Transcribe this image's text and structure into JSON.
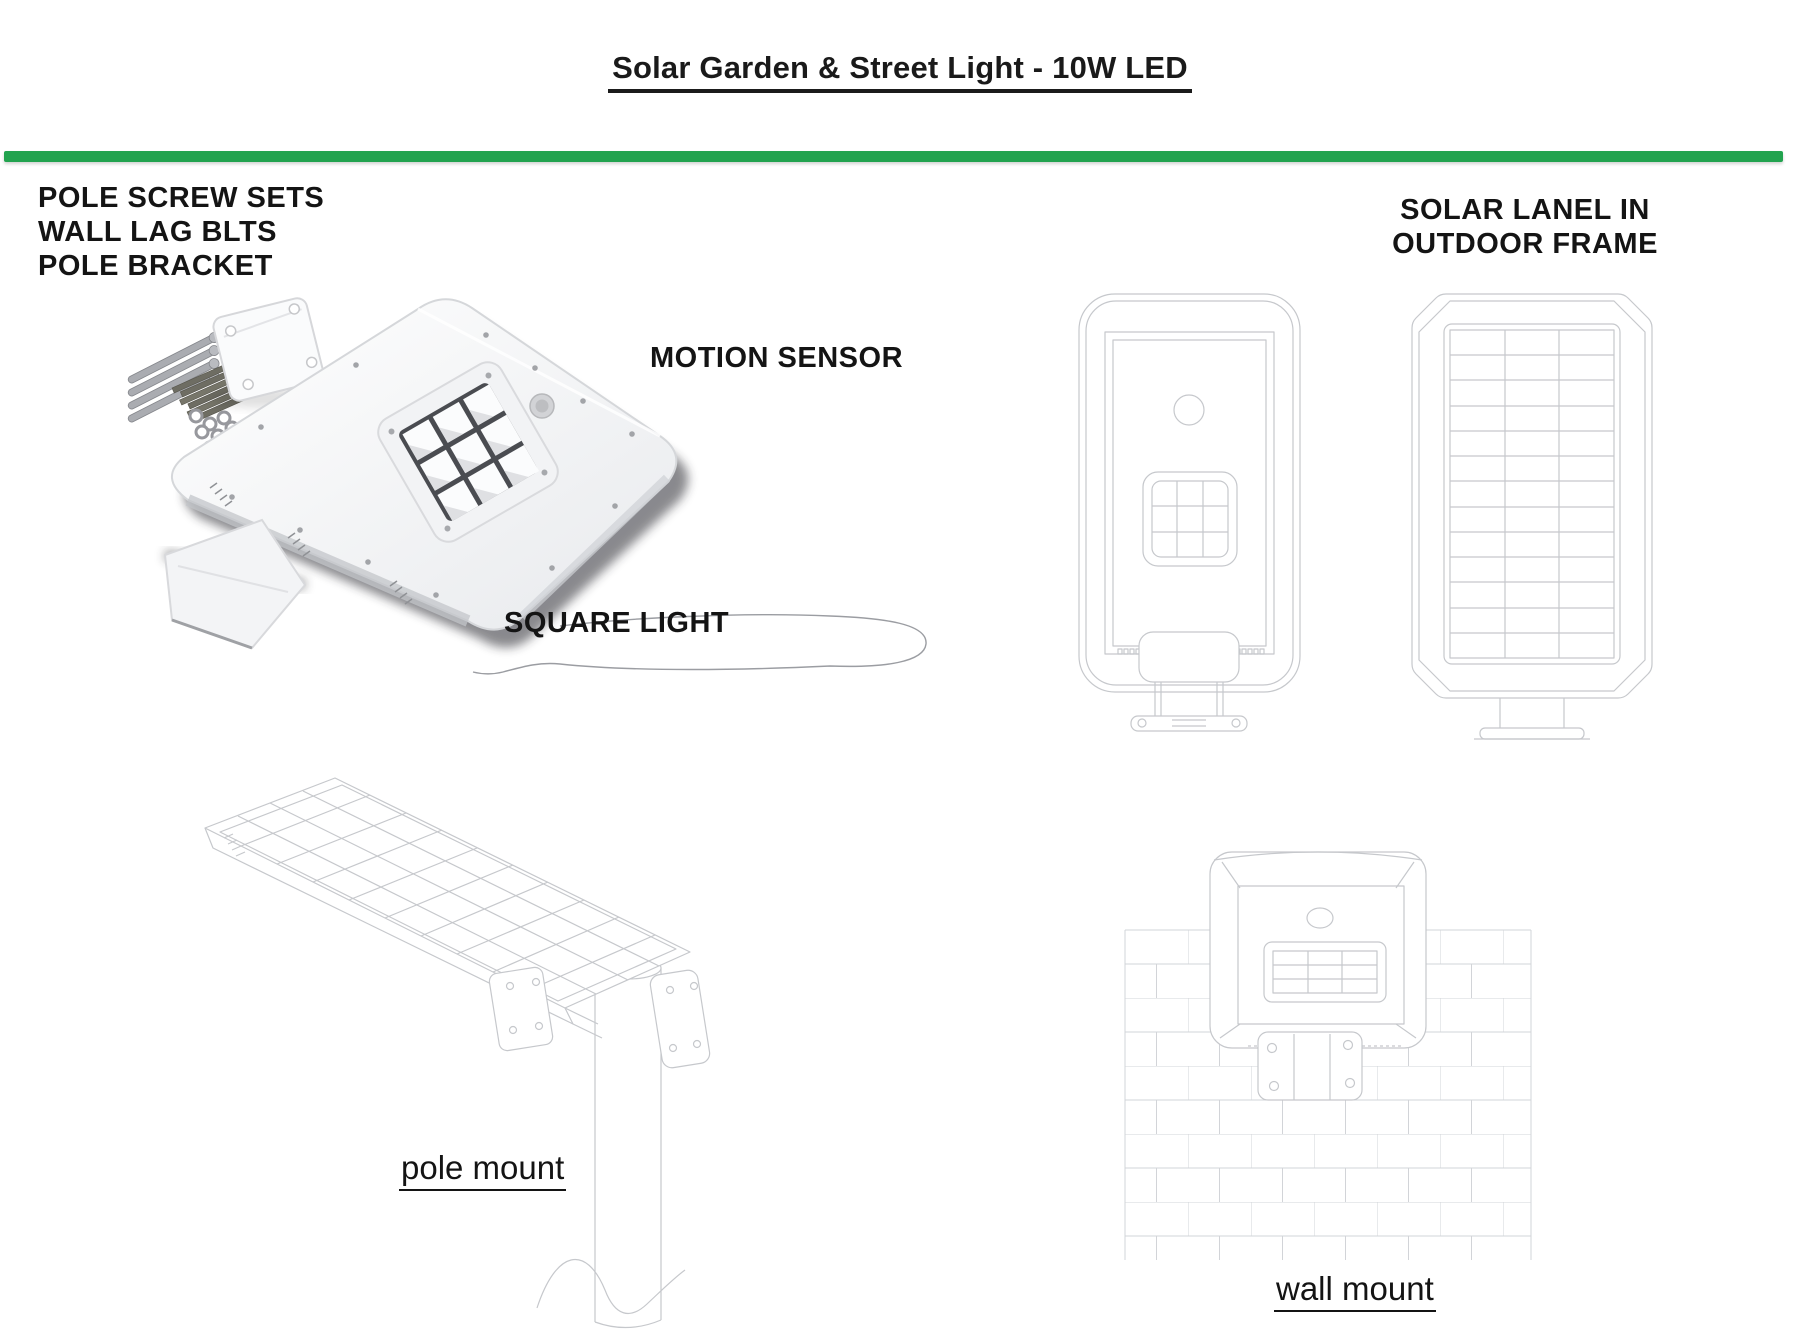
{
  "page": {
    "title": "Solar Garden & Street Light - 10W LED",
    "background": "#ffffff",
    "text_color": "#141414"
  },
  "colors": {
    "accent_green": "#22a34f",
    "drawing_line": "#c6c8cc",
    "brick_line": "#d2d4d8"
  },
  "labels": {
    "hardware_kit": {
      "lines": [
        "POLE SCREW SETS",
        "WALL LAG BLTS",
        "POLE BRACKET"
      ]
    },
    "solar_frame": {
      "lines": [
        "SOLAR LANEL IN",
        "OUTDOOR FRAME"
      ]
    },
    "motion_sensor": "MOTION SENSOR",
    "square_light": "SQUARE LIGHT",
    "pole_mount": "pole mount",
    "wall_mount": "wall mount"
  }
}
